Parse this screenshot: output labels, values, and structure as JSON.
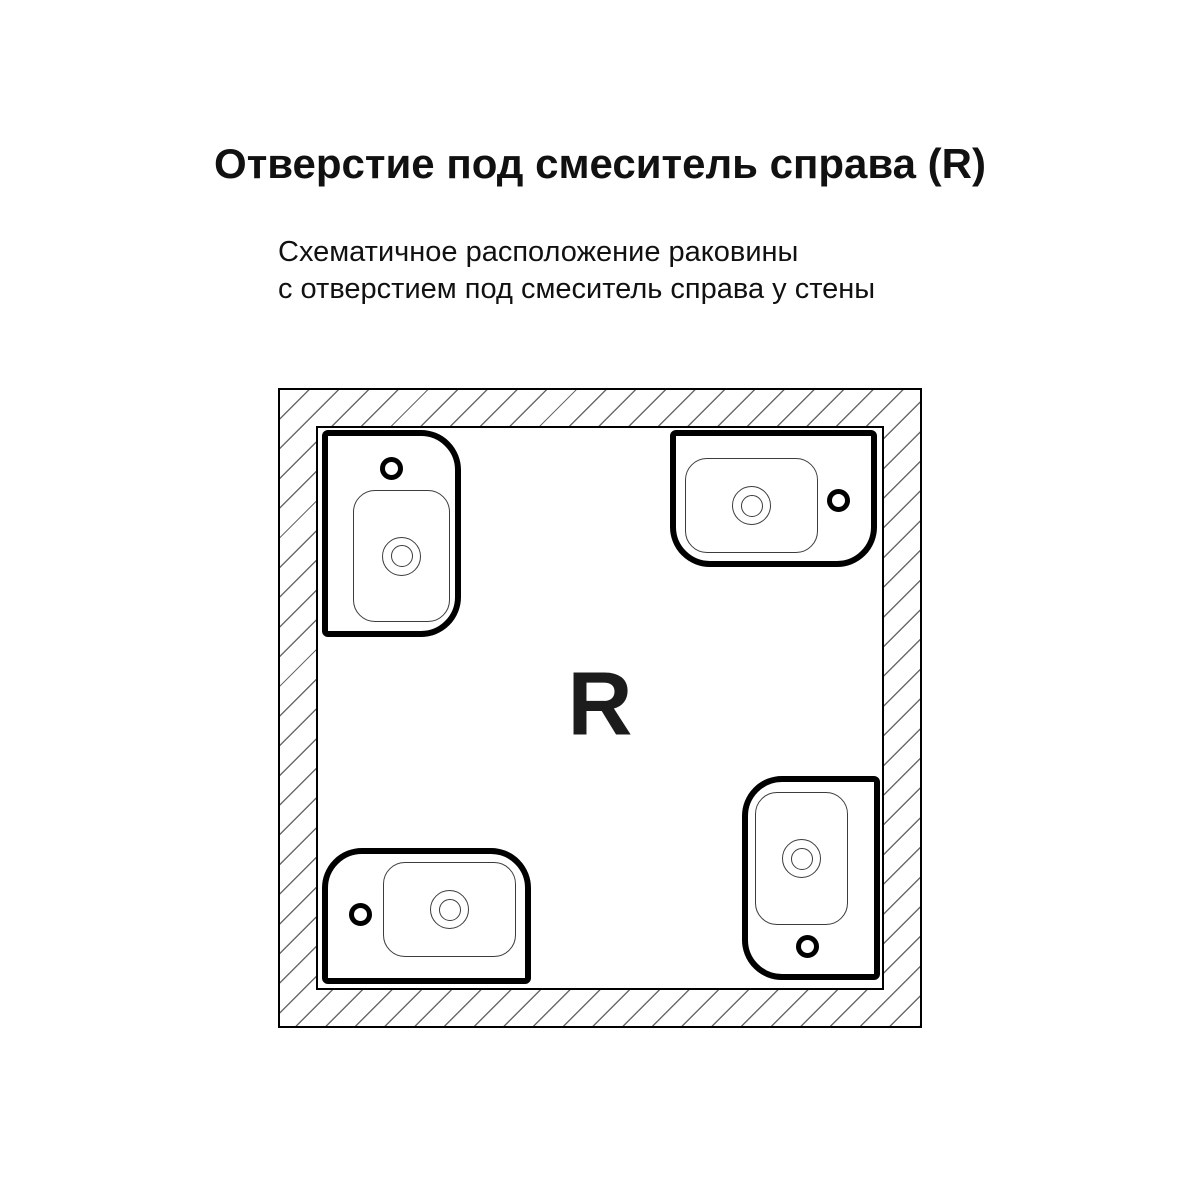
{
  "header": {
    "title": "Отверстие под смеситель справа (R)",
    "subtitle_line1": "Схематичное расположение раковины",
    "subtitle_line2": "с отверстием под смеситель справа у стены"
  },
  "diagram": {
    "room_label": "R",
    "walls": "hatched-square-frame",
    "sinks": [
      {
        "position": "top-left",
        "mounted_wall": "left",
        "faucet_hole_side": "top",
        "rounded_corners": "right"
      },
      {
        "position": "top-right",
        "mounted_wall": "top",
        "faucet_hole_side": "right",
        "rounded_corners": "bottom"
      },
      {
        "position": "bottom-left",
        "mounted_wall": "bottom",
        "faucet_hole_side": "left",
        "rounded_corners": "top"
      },
      {
        "position": "bottom-right",
        "mounted_wall": "right",
        "faucet_hole_side": "bottom",
        "rounded_corners": "left"
      }
    ]
  },
  "colors": {
    "line": "#000000",
    "basin_line": "#3c3c3c",
    "hatch": "#6b6b6b",
    "background": "#ffffff",
    "label": "#1c1c1c",
    "text": "#111111"
  }
}
